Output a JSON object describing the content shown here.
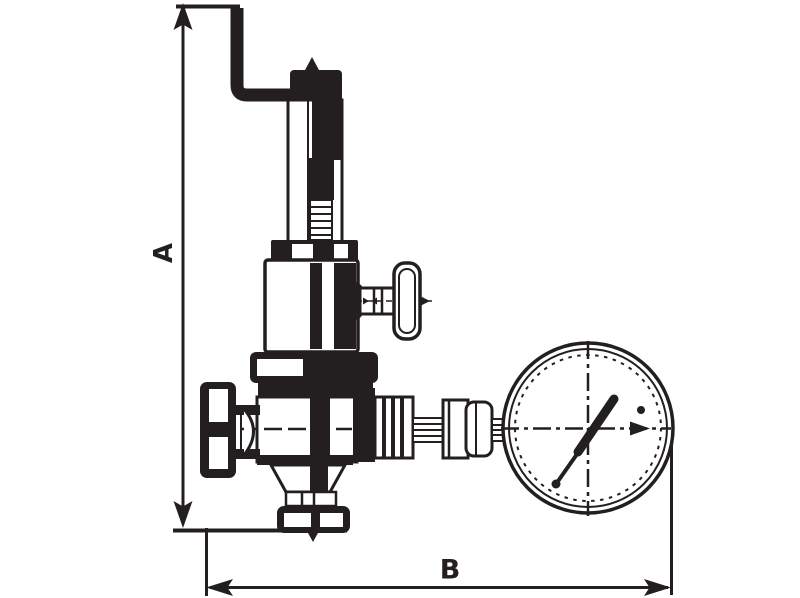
{
  "drawing": {
    "kind": "technical-dimensional-line-drawing",
    "subject": "pressure reducing valve with pressure gauge",
    "dimension_labels": {
      "vertical": "A",
      "horizontal": "B"
    },
    "components": [
      "bent-lever-pipe",
      "adjusting-stem",
      "spring-housing",
      "side-handwheel",
      "housing-flange",
      "valve-body",
      "inlet-cap",
      "outlet-fitting",
      "pressure-gauge",
      "gauge-needle",
      "bottom-flange"
    ]
  },
  "colors": {
    "ink": "#231f20",
    "paper": "#ffffff"
  }
}
